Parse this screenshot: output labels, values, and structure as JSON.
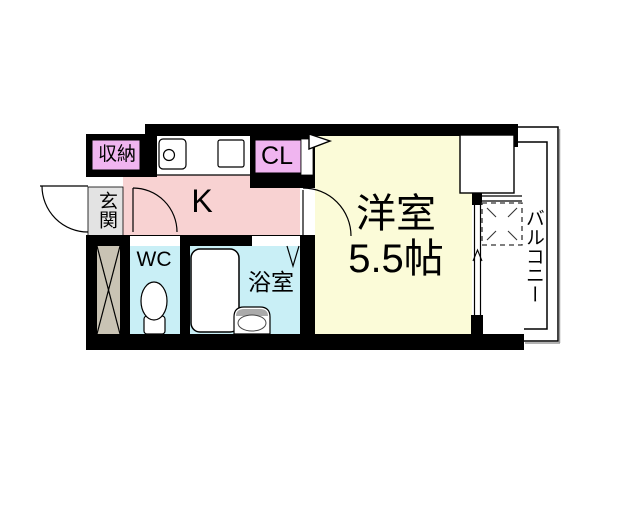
{
  "floorplan": {
    "labels": {
      "storage": "収納",
      "entrance": "玄関",
      "kitchen": "K",
      "closet": "CL",
      "western_room": "洋室",
      "western_room_size": "5.5帖",
      "toilet": "WC",
      "bathroom": "浴室",
      "balcony": "バルコニー"
    },
    "colors": {
      "wall": "#000000",
      "kitchen_floor": "#f8d2d2",
      "storage_and_closet": "#f0b5f0",
      "western_room_floor": "#fbfbd8",
      "wet_area_floor": "#c9eff6",
      "entrance_floor": "#e3e3e3",
      "pipe_space": "#c9c3b4",
      "fixture_fill": "#ffffff"
    }
  }
}
